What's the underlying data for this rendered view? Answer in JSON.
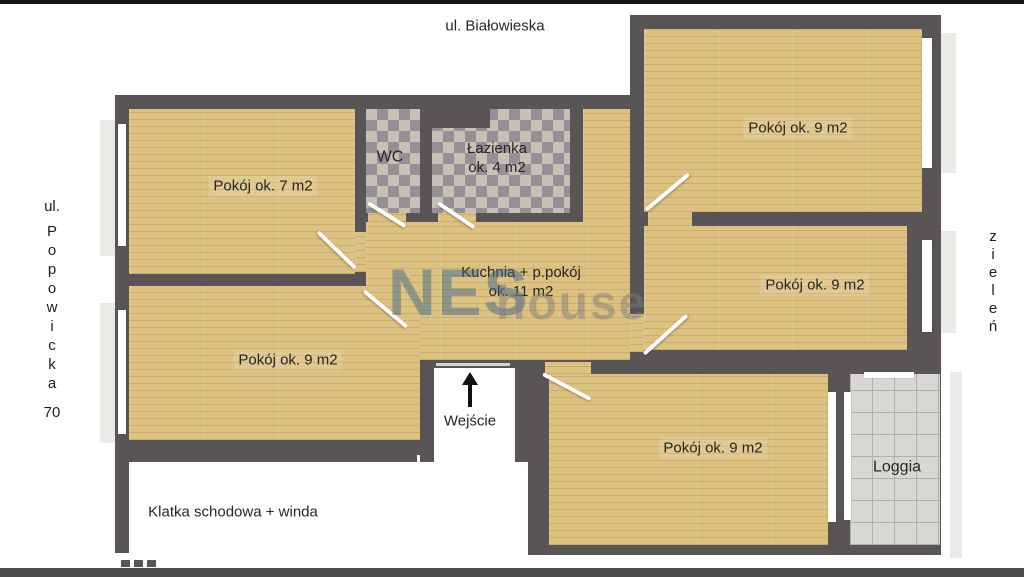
{
  "page": {
    "top_bar_color": "#141414",
    "bottom_bar_color": "#4e4b4c"
  },
  "streets": {
    "top": "ul. Białowieska",
    "left_prefix": "ul.",
    "left_name_stacked": "P\no\np\no\nw\ni\nc\nk\na",
    "left_number": "70",
    "right_stacked": "z\ni\ne\nl\ne\nń"
  },
  "rooms": {
    "room_top_right": "Pokój ok. 9 m2",
    "room_left": "Pokój ok. 7 m2",
    "wc": "WC",
    "bathroom": "Łazienka\nok. 4 m2",
    "kitchen": "Kuchnia + p.pokój\nok. 11 m2",
    "room_mid_right": "Pokój ok. 9 m2",
    "room_bottom_left": "Pokój ok. 9 m2",
    "room_bottom": "Pokój ok. 9 m2",
    "loggia": "Loggia",
    "staircase": "Klatka schodowa + winda",
    "entrance": "Wejście"
  },
  "watermark": {
    "part1": "NES",
    "part2": "house",
    "color1": "rgba(62,105,138,0.50)",
    "color2": "rgba(125,125,125,0.48)"
  },
  "colors": {
    "wall": "#595456",
    "wood_floor": "#dcc180",
    "bath_tile": "#c7c0b7",
    "loggia_tile": "#d9d7d4",
    "window": "#ffffff"
  }
}
